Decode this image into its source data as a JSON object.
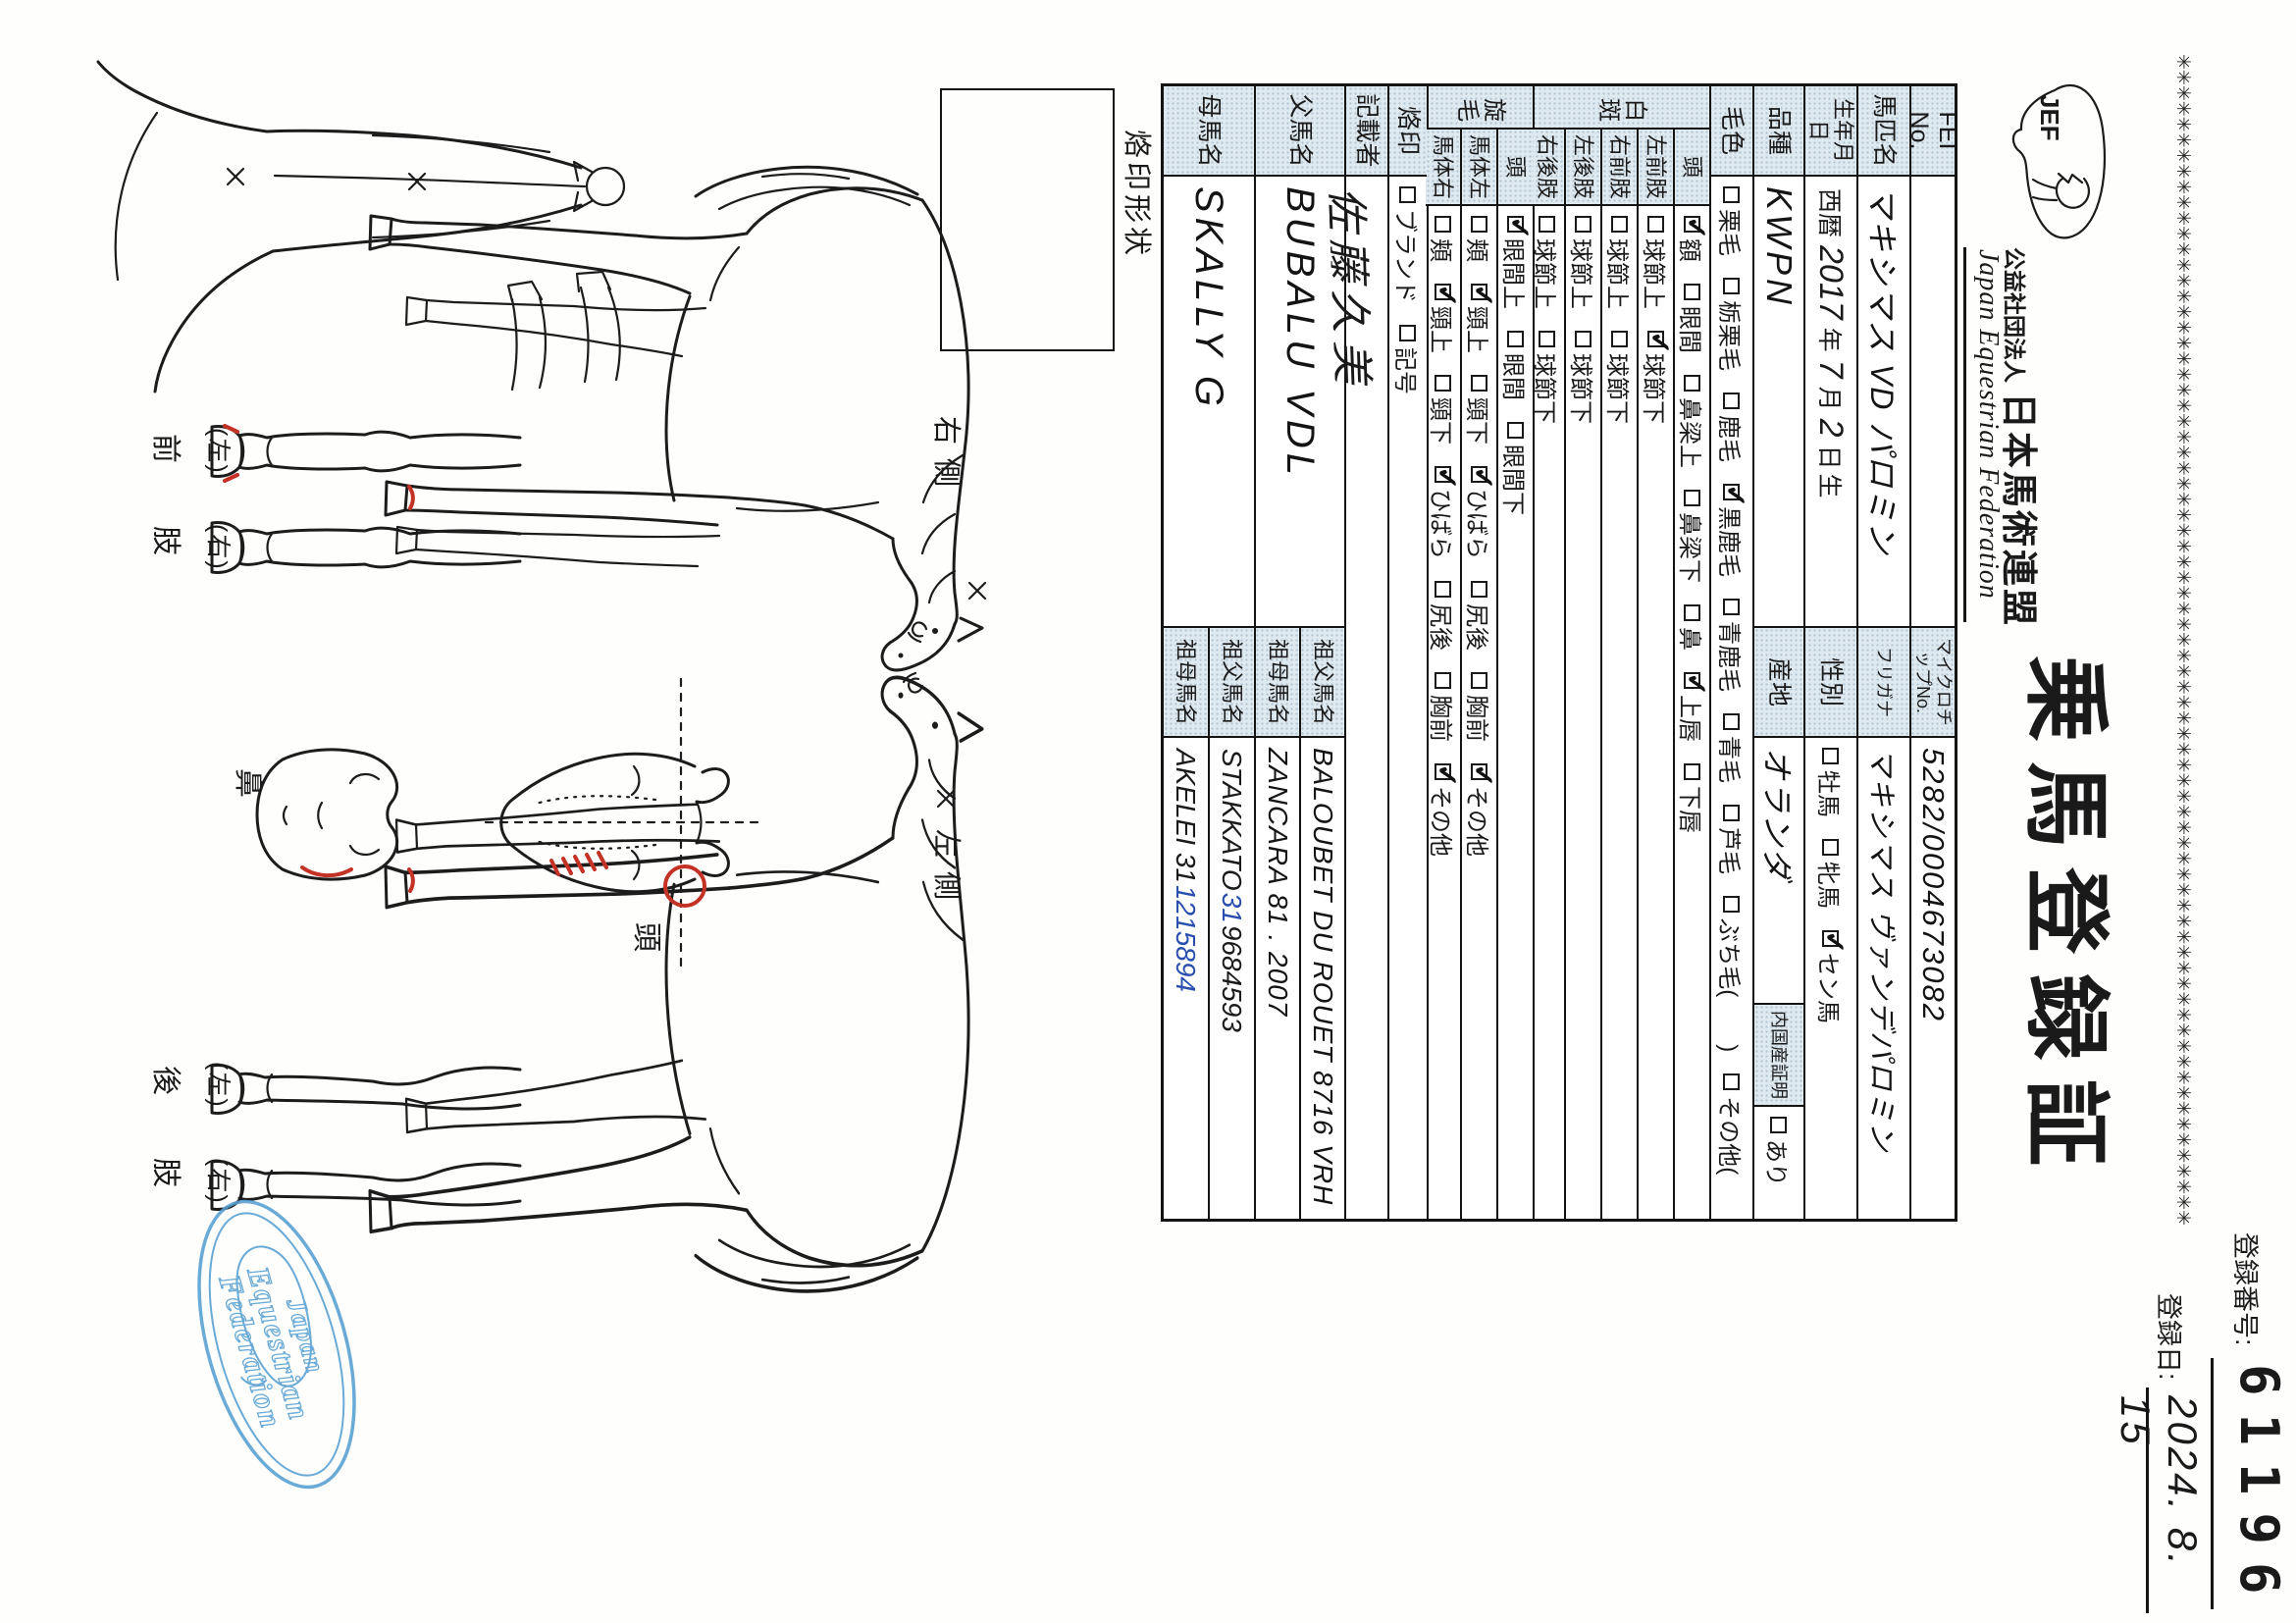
{
  "border": {
    "asterisk_line": "✳✳✳✳✳✳✳✳✳✳✳✳✳✳✳✳✳✳✳✳✳✳✳✳✳✳✳✳✳✳✳✳✳✳✳✳✳✳✳✳✳✳✳✳✳✳✳✳✳✳✳✳✳✳✳✳✳✳✳✳✳✳✳✳✳✳✳✳✳✳✳✳✳✳✳"
  },
  "cert": {
    "title": "乗馬登録証",
    "reg_no_label": "登録番号:",
    "reg_no": "61196",
    "reg_date_label": "登録日:",
    "reg_date": "2024. 8. 15"
  },
  "org": {
    "type": "公益社団法人",
    "name_jp": "日本馬術連盟",
    "name_en": "Japan Equestrian Federation",
    "address": "〒104-0033 東京都中央区新川2-6-16",
    "tel": "TEL:03-3297-5611",
    "logo_text": "JEF"
  },
  "table": {
    "fei": {
      "label": "FEI No.",
      "value": ""
    },
    "microchip": {
      "label": "マイクロチップNo.",
      "value": "5282/0004673082"
    },
    "name": {
      "label": "馬匹名",
      "value": "マキシマス VD パロミン"
    },
    "furigana": {
      "label": "フリガナ",
      "value": "マキシマス ヴァンデパロミン"
    },
    "birth": {
      "label": "生年月日",
      "parts": [
        {
          "t": "西暦",
          "hw": false
        },
        {
          "t": "2017",
          "hw": true
        },
        {
          "t": "年",
          "hw": false
        },
        {
          "t": "7",
          "hw": true
        },
        {
          "t": "月",
          "hw": false
        },
        {
          "t": "2",
          "hw": true
        },
        {
          "t": "日",
          "hw": false
        },
        {
          "t": "生",
          "hw": false
        }
      ]
    },
    "sex": {
      "label": "性別",
      "options": [
        {
          "label": "牡馬",
          "checked": false
        },
        {
          "label": "牝馬",
          "checked": false
        },
        {
          "label": "セン馬",
          "checked": true
        }
      ]
    },
    "breed": {
      "label": "品種",
      "value": "KWPN"
    },
    "origin": {
      "label": "産地",
      "value": "オランダ"
    },
    "domestic": {
      "label": "内国産証明",
      "options": [
        {
          "label": "あり",
          "checked": false
        }
      ]
    },
    "coat": {
      "label": "毛色",
      "options": [
        {
          "label": "栗毛",
          "checked": false
        },
        {
          "label": "栃栗毛",
          "checked": false
        },
        {
          "label": "鹿毛",
          "checked": false
        },
        {
          "label": "黒鹿毛",
          "checked": true
        },
        {
          "label": "青鹿毛",
          "checked": false
        },
        {
          "label": "青毛",
          "checked": false
        },
        {
          "label": "芦毛",
          "checked": false
        },
        {
          "label": "ぶち毛(　　)",
          "checked": false
        },
        {
          "label": "その他(　　)",
          "checked": false
        }
      ]
    },
    "markings": {
      "label": "白斑",
      "rows": [
        {
          "label": "頭",
          "options": [
            {
              "label": "額",
              "checked": true
            },
            {
              "label": "眼間",
              "checked": false
            },
            {
              "label": "鼻梁上",
              "checked": false
            },
            {
              "label": "鼻梁下",
              "checked": false
            },
            {
              "label": "鼻",
              "checked": false
            },
            {
              "label": "上唇",
              "checked": true
            },
            {
              "label": "下唇",
              "checked": false
            }
          ]
        },
        {
          "label": "左前肢",
          "options": [
            {
              "label": "球節上",
              "checked": false
            },
            {
              "label": "球節下",
              "checked": true
            }
          ]
        },
        {
          "label": "右前肢",
          "options": [
            {
              "label": "球節上",
              "checked": false
            },
            {
              "label": "球節下",
              "checked": false
            }
          ]
        },
        {
          "label": "左後肢",
          "options": [
            {
              "label": "球節上",
              "checked": false
            },
            {
              "label": "球節下",
              "checked": false
            }
          ]
        },
        {
          "label": "右後肢",
          "options": [
            {
              "label": "球節上",
              "checked": false
            },
            {
              "label": "球節下",
              "checked": false
            }
          ]
        }
      ]
    },
    "whorls": {
      "label": "旋毛",
      "rows": [
        {
          "label": "頭",
          "options": [
            {
              "label": "眼間上",
              "checked": true
            },
            {
              "label": "眼間",
              "checked": false
            },
            {
              "label": "眼間下",
              "checked": false
            }
          ]
        },
        {
          "label": "馬体左",
          "options": [
            {
              "label": "頬",
              "checked": false
            },
            {
              "label": "頸上",
              "checked": true
            },
            {
              "label": "頸下",
              "checked": false
            },
            {
              "label": "ひばら",
              "checked": true
            },
            {
              "label": "尻後",
              "checked": false
            },
            {
              "label": "胸前",
              "checked": false
            },
            {
              "label": "その他",
              "checked": true
            }
          ]
        },
        {
          "label": "馬体右",
          "options": [
            {
              "label": "頬",
              "checked": false
            },
            {
              "label": "頸上",
              "checked": true
            },
            {
              "label": "頸下",
              "checked": false
            },
            {
              "label": "ひばら",
              "checked": true
            },
            {
              "label": "尻後",
              "checked": false
            },
            {
              "label": "胸前",
              "checked": false
            },
            {
              "label": "その他",
              "checked": true
            }
          ]
        }
      ]
    },
    "brand": {
      "label": "烙印",
      "options": [
        {
          "label": "ブランド",
          "checked": false
        },
        {
          "label": "記号",
          "checked": false
        }
      ]
    },
    "recorder": {
      "label": "記載者",
      "value": "佐藤久美"
    },
    "sire": {
      "label": "父馬名",
      "value": "BUBALU VDL",
      "grandsire": {
        "label": "祖父馬名",
        "value": "BALOUBET DU ROUET 8716 VRH"
      },
      "granddam": {
        "label": "祖母馬名",
        "value": "ZANCARA 81 . 2007"
      }
    },
    "dam": {
      "label": "母馬名",
      "value": "SKALLY G",
      "grandsire": {
        "label": "祖父馬名",
        "parts": [
          {
            "t": "STAKKATO ",
            "hw": true
          },
          {
            "t": "31",
            "hw": true,
            "blue": true
          },
          {
            "t": " 9684593",
            "hw": true
          }
        ]
      },
      "granddam": {
        "label": "祖母馬名",
        "parts": [
          {
            "t": "AKELEI 31 ",
            "hw": true
          },
          {
            "t": "1215894",
            "hw": true,
            "blue": true
          }
        ]
      }
    }
  },
  "diagram": {
    "brand_shape_label": "烙印形状",
    "right_side": "右側",
    "left_side": "左側",
    "head": "頭",
    "nose": "鼻",
    "front_leg": "前肢",
    "hind_leg": "後肢",
    "left_mark": "(左)",
    "right_mark": "(右)",
    "stamp": {
      "line1": "Japan",
      "line2": "Equestrian",
      "line3": "Federation",
      "color": "#569fd2"
    }
  }
}
